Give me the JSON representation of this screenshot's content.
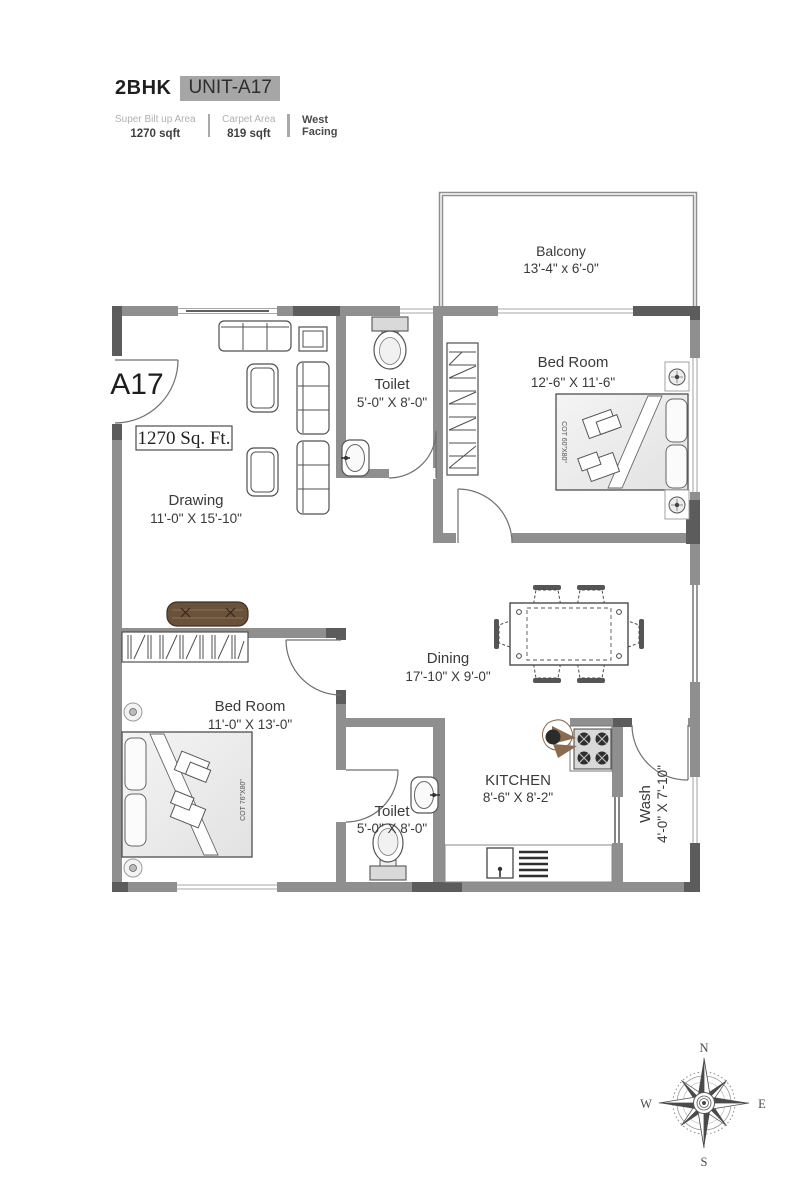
{
  "header": {
    "type_label": "2BHK",
    "unit_label": "UNIT-A17",
    "stats": [
      {
        "label": "Super Bilt up Area",
        "value": "1270 sqft"
      },
      {
        "label": "Carpet Area",
        "value": "819 sqft"
      }
    ],
    "facing_line1": "West",
    "facing_line2": "Facing"
  },
  "plan": {
    "unit_tag": "A17",
    "area_tag": "1270 Sq. Ft.",
    "rooms": [
      {
        "name": "Balcony",
        "dims": "13'-4\" x 6'-0\""
      },
      {
        "name": "Bed Room",
        "dims": "12'-6\" X 11'-6\""
      },
      {
        "name": "Toilet",
        "dims": "5'-0\" X 8'-0\""
      },
      {
        "name": "Drawing",
        "dims": "11'-0\" X 15'-10\""
      },
      {
        "name": "Dining",
        "dims": "17'-10\" X 9'-0\""
      },
      {
        "name": "Bed Room",
        "dims": "11'-0\" X 13'-0\""
      },
      {
        "name": "Toilet",
        "dims": "5'-0\" X 8'-0\""
      },
      {
        "name": "KITCHEN",
        "dims": "8'-6\" X 8'-2\""
      },
      {
        "name": "Wash",
        "dims": "4'-0\" X 7'-10\""
      }
    ],
    "cot1": "COT 60\"X80\"",
    "cot2": "COT 76\"X80\"",
    "compass": {
      "n": "N",
      "e": "E",
      "s": "S",
      "w": "W"
    }
  },
  "colors": {
    "wall": "#8f8f8f",
    "wall_dark": "#5c5c5c",
    "chip_bg": "#a6a6a6",
    "text": "#3a3a3a"
  }
}
